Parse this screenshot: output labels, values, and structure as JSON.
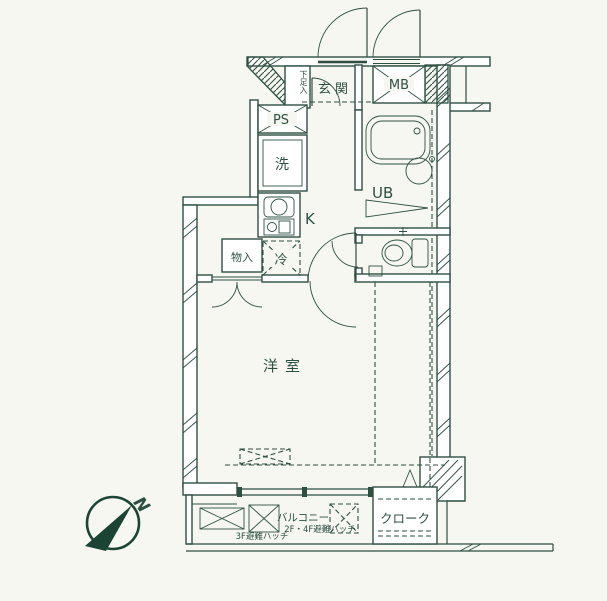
{
  "colors": {
    "background": "#f6f7f1",
    "line": "#2e5043",
    "compass_fill": "#1c4434"
  },
  "labels": {
    "genkan": "玄関",
    "shoebox": "下足入",
    "mb": "MB",
    "ps": "PS",
    "washer": "洗",
    "ub": "UB",
    "kitchen": "K",
    "fridge": "冷",
    "storage": "物入",
    "room": "洋室",
    "cloak": "クローク",
    "balcony": "バルコニー",
    "hatch_3f": "3F避難ハッチ",
    "hatch_2f4f": "2F・4F避難ハッチ",
    "north": "N"
  }
}
